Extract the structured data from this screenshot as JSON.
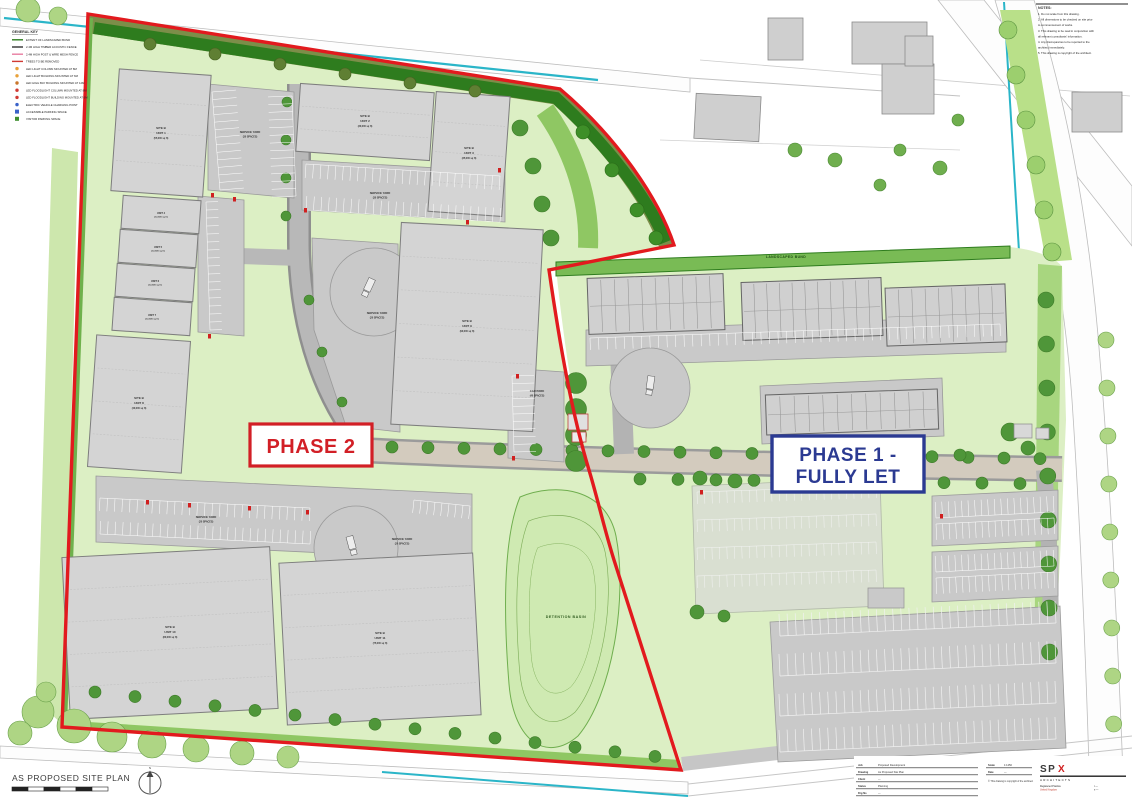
{
  "page": {
    "title": "As Proposed Site Plan"
  },
  "colors": {
    "boundary_red": "#e21a1e",
    "phase1_blue": "#2b3a92",
    "phase2_red": "#d21f26",
    "site_green_light": "#dcefc4",
    "verge_green": "#6fb14c",
    "bund_olive": "#7c8e49",
    "bund_dark": "#2e7c1e",
    "building_gray": "#d4d4d4",
    "road_gray": "#b8b8b8",
    "spine_beige": "#d3cbbe",
    "water_teal": "#2ab5c8",
    "tree_green": "#4f9639"
  },
  "legend": {
    "title": "GENERAL KEY",
    "items": [
      {
        "type": "line",
        "swatch": "#2e7c1e",
        "label": "EXTENT OF LANDSCAPED BUND"
      },
      {
        "type": "line",
        "swatch": "#333333",
        "label": "2.4M HIGH TIMBER ACOUSTIC FENCE"
      },
      {
        "type": "line",
        "swatch": "#e87ea0",
        "label": "2.4M HIGH POST & WIRE MESH FENCE"
      },
      {
        "type": "line",
        "swatch": "#d03a34",
        "label": "TREES TO BE REMOVED"
      },
      {
        "type": "dot",
        "swatch": "#e8a13a",
        "label": "LED LIGHT COLUMN MOUNTED AT 8M"
      },
      {
        "type": "dot",
        "swatch": "#e8a13a",
        "label": "LED LIGHT BUILDING MOUNTED AT 6M"
      },
      {
        "type": "dot",
        "swatch": "#c9762c",
        "label": "LED HIGH BAY BUILDING MOUNTED AT 12M"
      },
      {
        "type": "dot",
        "swatch": "#d03a34",
        "label": "LED FLOODLIGHT COLUMN MOUNTED AT 8M"
      },
      {
        "type": "dot",
        "swatch": "#d03a34",
        "label": "LED FLOODLIGHT BUILDING MOUNTED AT 6M"
      },
      {
        "type": "dot",
        "swatch": "#3a62c9",
        "label": "ELECTRIC VEHICLE CHARGING POINT"
      },
      {
        "type": "square",
        "swatch": "#3a62c9",
        "label": "ACCESSIBLE PARKING SPACE"
      },
      {
        "type": "square",
        "swatch": "#3f8f2f",
        "label": "VISITOR PARKING SPACE"
      }
    ]
  },
  "notes": {
    "title": "NOTES:",
    "lines": [
      "1.  Do not scale from this drawing.",
      "2.  All dimensions to be checked on site prior",
      "     to commencement of works.",
      "3.  This drawing to be read in conjunction with",
      "     all relevant consultants' information.",
      "4.  Any discrepancies to be reported to the",
      "     architect immediately.",
      "5.  This drawing is copyright of the architect."
    ]
  },
  "phase2": {
    "label": "PHASE 2"
  },
  "phase1": {
    "label_line1": "PHASE 1 -",
    "label_line2": "FULLY LET"
  },
  "area_labels": {
    "landscaped_bund": "LANDSCAPED BUND",
    "detention_basin": "DETENTION BASIN",
    "service_yard": "SERVICE YARD",
    "service_spaces": "(20 SPACES)",
    "service_spaces_lg": "(30 SPACES)",
    "car_park": "CAR PARK",
    "car_park_spaces": "(40 SPACES)"
  },
  "units": [
    {
      "name": "SITE B",
      "unit": "UNIT 1",
      "area": "(55,000 sq ft)"
    },
    {
      "name": "SITE B",
      "unit": "UNIT 2",
      "area": "(30,000 sq ft)"
    },
    {
      "name": "SITE B",
      "unit": "UNIT 3",
      "area": "(35,000 sq ft)"
    },
    {
      "name": "SITE B",
      "unit": "UNIT 4",
      "area": "(12,500 sq ft)"
    },
    {
      "name": "SITE B",
      "unit": "UNIT 5",
      "area": "(12,500 sq ft)"
    },
    {
      "name": "SITE B",
      "unit": "UNIT 6",
      "area": "(12,500 sq ft)"
    },
    {
      "name": "SITE B",
      "unit": "UNIT 7",
      "area": "(12,500 sq ft)"
    },
    {
      "name": "SITE B",
      "unit": "UNIT 8",
      "area": "(40,000 sq ft)"
    },
    {
      "name": "SITE B",
      "unit": "UNIT 9",
      "area": "(90,000 sq ft)"
    },
    {
      "name": "SITE B",
      "unit": "UNIT 10",
      "area": "(80,000 sq ft)"
    },
    {
      "name": "SITE B",
      "unit": "UNIT 11",
      "area": "(75,000 sq ft)"
    }
  ],
  "footer": {
    "drawing_title": "AS PROPOSED SITE PLAN",
    "north": "N"
  },
  "title_block": {
    "rows_left": [
      {
        "label": "Job",
        "value": "Proposed Development"
      },
      {
        "label": "Drawing",
        "value": "As Proposed Site Plan"
      },
      {
        "label": "Client",
        "value": "—"
      },
      {
        "label": "Status",
        "value": "Planning"
      },
      {
        "label": "Drg No",
        "value": "—"
      }
    ],
    "rows_mid": [
      {
        "label": "Scale",
        "value": "1:1250"
      },
      {
        "label": "Date",
        "value": "—"
      }
    ],
    "note": "© This drawing is copyright of the architect",
    "logo_prefix": "SP",
    "logo_x": "X",
    "logo_sub": "ARCHITECTS",
    "address_lines": [
      "Registered Practice",
      "United Kingdom"
    ],
    "contact_lines": [
      "t  —",
      "e  —"
    ]
  }
}
